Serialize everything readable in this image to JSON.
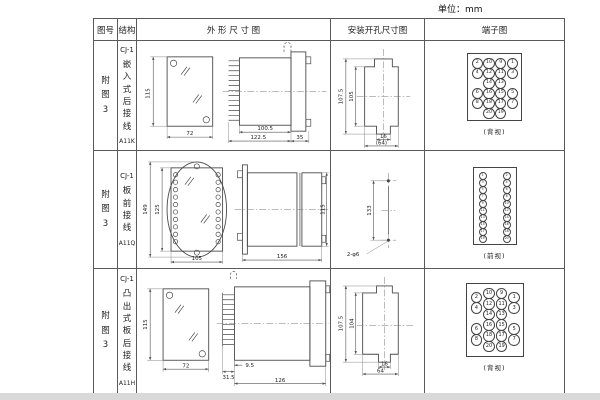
{
  "unit_label": "单位：mm",
  "headers": {
    "fig": "图号",
    "structure": "结构",
    "outline": "外 形 尺 寸 图",
    "install": "安装开孔尺寸图",
    "terminal": "端子图"
  },
  "rows": [
    {
      "fig_no": "附图3",
      "structure": {
        "model": "CJ-1",
        "mount": "嵌入式后接线",
        "code": "A11K"
      },
      "outline": {
        "front_h": "115",
        "front_w": "72",
        "side_a": "100.5",
        "side_b": "122.5",
        "side_c": "35"
      },
      "install": {
        "dim_outer": "107.5",
        "dim_inner": "105",
        "dim_tab": "16",
        "dim_overall": "(64)"
      },
      "terminal": {
        "view_label": "(背视)",
        "cells": [
          {
            "r": 0,
            "c": 0,
            "n": "2"
          },
          {
            "r": 0,
            "c": 1,
            "n": "10"
          },
          {
            "r": 0,
            "c": 2,
            "n": "9"
          },
          {
            "r": 0,
            "c": 3,
            "n": "1"
          },
          {
            "r": 1,
            "c": 0,
            "n": "4"
          },
          {
            "r": 1,
            "c": 1,
            "n": "12"
          },
          {
            "r": 1,
            "c": 2,
            "n": "11"
          },
          {
            "r": 1,
            "c": 3,
            "n": "3"
          },
          {
            "r": 2,
            "c": 1,
            "n": "14"
          },
          {
            "r": 2,
            "c": 2,
            "n": "13"
          },
          {
            "r": 3,
            "c": 0,
            "n": "6"
          },
          {
            "r": 3,
            "c": 1,
            "n": "16"
          },
          {
            "r": 3,
            "c": 2,
            "n": "15"
          },
          {
            "r": 3,
            "c": 3,
            "n": "5"
          },
          {
            "r": 4,
            "c": 0,
            "n": "8"
          },
          {
            "r": 4,
            "c": 1,
            "n": "18"
          },
          {
            "r": 4,
            "c": 2,
            "n": "17"
          },
          {
            "r": 4,
            "c": 3,
            "n": "7"
          },
          {
            "r": 5,
            "c": 1,
            "n": "20"
          },
          {
            "r": 5,
            "c": 2,
            "n": "19"
          }
        ]
      }
    },
    {
      "fig_no": "附图3",
      "structure": {
        "model": "CJ-1",
        "mount": "板前接线",
        "code": "A11Q"
      },
      "outline": {
        "front_h": "149",
        "front_h2": "125",
        "front_w": "105",
        "side_len": "156",
        "side_h": "115"
      },
      "install": {
        "dim_span": "133",
        "hole_label": "2-φ6"
      },
      "terminal": {
        "view_label": "(前视)",
        "cells": [
          {
            "r": 0,
            "c": 0,
            "n": "1"
          },
          {
            "r": 0,
            "c": 1,
            "n": "2"
          },
          {
            "r": 1,
            "c": 0,
            "n": "3"
          },
          {
            "r": 1,
            "c": 1,
            "n": "4"
          },
          {
            "r": 2,
            "c": 0,
            "n": "5"
          },
          {
            "r": 2,
            "c": 1,
            "n": "6"
          },
          {
            "r": 3,
            "c": 0,
            "n": "7"
          },
          {
            "r": 3,
            "c": 1,
            "n": "8"
          },
          {
            "r": 4,
            "c": 0,
            "n": "9"
          },
          {
            "r": 4,
            "c": 1,
            "n": "10"
          },
          {
            "r": 5,
            "c": 0,
            "n": "11"
          },
          {
            "r": 5,
            "c": 1,
            "n": "12"
          },
          {
            "r": 6,
            "c": 0,
            "n": "13"
          },
          {
            "r": 6,
            "c": 1,
            "n": "14"
          },
          {
            "r": 7,
            "c": 0,
            "n": "15"
          },
          {
            "r": 7,
            "c": 1,
            "n": "16"
          },
          {
            "r": 8,
            "c": 0,
            "n": "17"
          },
          {
            "r": 8,
            "c": 1,
            "n": "18"
          },
          {
            "r": 9,
            "c": 0,
            "n": "19"
          },
          {
            "r": 9,
            "c": 1,
            "n": "20"
          }
        ]
      }
    },
    {
      "fig_no": "附图3",
      "structure": {
        "model": "CJ-1",
        "mount": "凸出式板后接线",
        "code": "A11H"
      },
      "outline": {
        "front_h": "115",
        "front_w": "72",
        "side_a": "31.5",
        "side_b": "9.5",
        "side_c": "126"
      },
      "install": {
        "dim_outer": "107.5",
        "dim_inner": "104",
        "dim_tab": "16",
        "dim_overall": "64"
      },
      "terminal": {
        "view_label": "(背视)",
        "cells": [
          {
            "r": 0,
            "c": 0,
            "n": "2"
          },
          {
            "r": 0,
            "c": 1,
            "n": "10"
          },
          {
            "r": 0,
            "c": 2,
            "n": "9"
          },
          {
            "r": 0,
            "c": 3,
            "n": "1"
          },
          {
            "r": 1,
            "c": 0,
            "n": "4"
          },
          {
            "r": 1,
            "c": 1,
            "n": "12"
          },
          {
            "r": 1,
            "c": 2,
            "n": "11"
          },
          {
            "r": 1,
            "c": 3,
            "n": "3"
          },
          {
            "r": 2,
            "c": 1,
            "n": "14"
          },
          {
            "r": 2,
            "c": 2,
            "n": "13"
          },
          {
            "r": 3,
            "c": 0,
            "n": "6"
          },
          {
            "r": 3,
            "c": 1,
            "n": "16"
          },
          {
            "r": 3,
            "c": 2,
            "n": "15"
          },
          {
            "r": 3,
            "c": 3,
            "n": "5"
          },
          {
            "r": 4,
            "c": 0,
            "n": "8"
          },
          {
            "r": 4,
            "c": 1,
            "n": "18"
          },
          {
            "r": 4,
            "c": 2,
            "n": "17"
          },
          {
            "r": 4,
            "c": 3,
            "n": "7"
          },
          {
            "r": 5,
            "c": 1,
            "n": "20"
          },
          {
            "r": 5,
            "c": 2,
            "n": "19"
          }
        ]
      }
    }
  ]
}
